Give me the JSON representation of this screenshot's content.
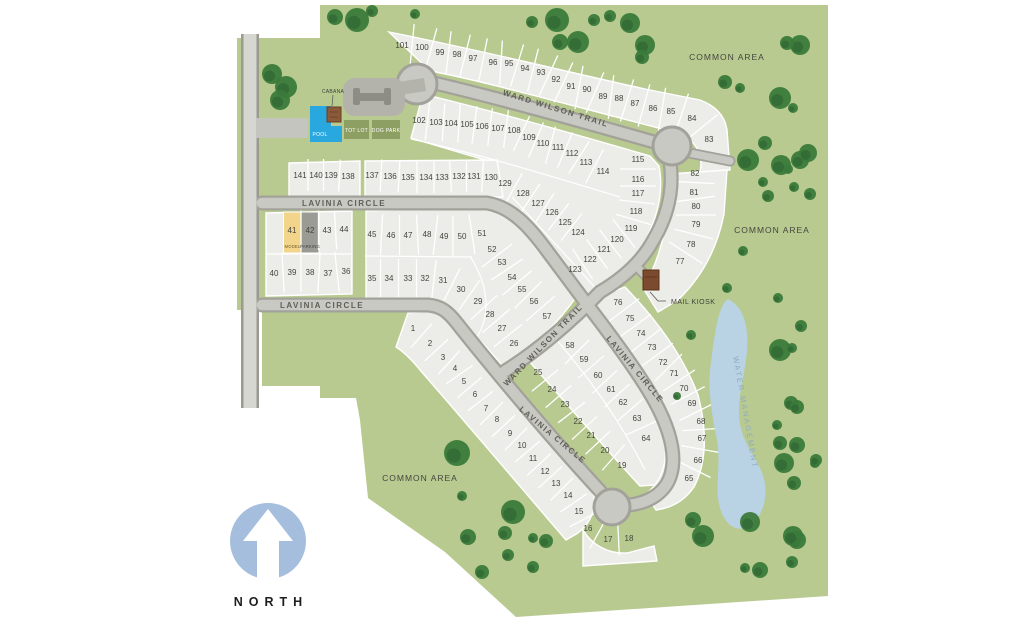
{
  "map": {
    "north_label": "NORTH",
    "street_labels": [
      {
        "text": "WARD WILSON TRAIL",
        "x": 555,
        "y": 111,
        "rotate": 17
      },
      {
        "text": "WARD WILSON TRAIL",
        "x": 545,
        "y": 347,
        "rotate": -46
      },
      {
        "text": "LAVINIA CIRCLE",
        "x": 344,
        "y": 206,
        "rotate": 0
      },
      {
        "text": "LAVINIA CIRCLE",
        "x": 322,
        "y": 308,
        "rotate": 0
      },
      {
        "text": "LAVINIA CIRCLE",
        "x": 633,
        "y": 371,
        "rotate": 50
      },
      {
        "text": "LAVINIA CIRCLE",
        "x": 551,
        "y": 437,
        "rotate": 40
      }
    ],
    "area_labels": [
      {
        "text": "COMMON AREA",
        "x": 727,
        "y": 60
      },
      {
        "text": "COMMON AREA",
        "x": 772,
        "y": 233
      },
      {
        "text": "COMMON AREA",
        "x": 420,
        "y": 481
      }
    ],
    "water_label": {
      "text": "WATER MANAGEMENT",
      "x": 743,
      "y": 413,
      "rotate": 80
    },
    "amenities": {
      "cabana": "CABANA",
      "pool": "POOL",
      "tot_lot": "TOT LOT",
      "dog_park": "DOG PARK",
      "mail_kiosk": "MAIL KIOSK"
    },
    "special_lots": {
      "model": "MODEL",
      "parking": "PARKING"
    },
    "lots": [
      [
        1,
        413,
        328
      ],
      [
        2,
        430,
        343
      ],
      [
        3,
        443,
        357
      ],
      [
        4,
        455,
        368
      ],
      [
        5,
        464,
        381
      ],
      [
        6,
        475,
        394
      ],
      [
        7,
        486,
        408
      ],
      [
        8,
        497,
        419
      ],
      [
        9,
        510,
        433
      ],
      [
        10,
        522,
        445
      ],
      [
        11,
        533,
        458
      ],
      [
        12,
        545,
        471
      ],
      [
        13,
        556,
        483
      ],
      [
        14,
        568,
        495
      ],
      [
        15,
        579,
        511
      ],
      [
        16,
        588,
        528
      ],
      [
        17,
        608,
        539
      ],
      [
        18,
        629,
        538
      ],
      [
        19,
        622,
        465
      ],
      [
        20,
        605,
        450
      ],
      [
        21,
        591,
        435
      ],
      [
        22,
        578,
        421
      ],
      [
        23,
        565,
        404
      ],
      [
        24,
        552,
        389
      ],
      [
        25,
        538,
        372
      ],
      [
        26,
        514,
        343
      ],
      [
        27,
        502,
        328
      ],
      [
        28,
        490,
        314
      ],
      [
        29,
        478,
        301
      ],
      [
        30,
        461,
        289
      ],
      [
        31,
        443,
        280
      ],
      [
        32,
        425,
        278
      ],
      [
        33,
        408,
        278
      ],
      [
        34,
        389,
        278
      ],
      [
        35,
        372,
        278
      ],
      [
        36,
        346,
        271
      ],
      [
        37,
        328,
        273
      ],
      [
        38,
        310,
        272
      ],
      [
        39,
        292,
        272
      ],
      [
        40,
        274,
        273
      ],
      [
        41,
        292,
        230
      ],
      [
        42,
        310,
        230
      ],
      [
        43,
        327,
        230
      ],
      [
        44,
        344,
        229
      ],
      [
        45,
        372,
        234
      ],
      [
        46,
        391,
        235
      ],
      [
        47,
        408,
        235
      ],
      [
        48,
        427,
        234
      ],
      [
        49,
        444,
        236
      ],
      [
        50,
        462,
        236
      ],
      [
        51,
        482,
        233
      ],
      [
        52,
        492,
        249
      ],
      [
        53,
        502,
        262
      ],
      [
        54,
        512,
        277
      ],
      [
        55,
        522,
        289
      ],
      [
        56,
        534,
        301
      ],
      [
        57,
        547,
        316
      ],
      [
        58,
        570,
        345
      ],
      [
        59,
        584,
        359
      ],
      [
        60,
        598,
        375
      ],
      [
        61,
        611,
        389
      ],
      [
        62,
        623,
        402
      ],
      [
        63,
        637,
        418
      ],
      [
        64,
        646,
        438
      ],
      [
        65,
        689,
        478
      ],
      [
        66,
        698,
        460
      ],
      [
        67,
        702,
        438
      ],
      [
        68,
        701,
        421
      ],
      [
        69,
        692,
        403
      ],
      [
        70,
        684,
        388
      ],
      [
        71,
        674,
        373
      ],
      [
        72,
        663,
        362
      ],
      [
        73,
        652,
        347
      ],
      [
        74,
        641,
        333
      ],
      [
        75,
        630,
        318
      ],
      [
        76,
        618,
        302
      ],
      [
        77,
        680,
        261
      ],
      [
        78,
        691,
        244
      ],
      [
        79,
        696,
        224
      ],
      [
        80,
        696,
        206
      ],
      [
        81,
        694,
        192
      ],
      [
        82,
        695,
        173
      ],
      [
        83,
        709,
        139
      ],
      [
        84,
        692,
        118
      ],
      [
        85,
        671,
        111
      ],
      [
        86,
        653,
        108
      ],
      [
        87,
        635,
        103
      ],
      [
        88,
        619,
        98
      ],
      [
        89,
        603,
        96
      ],
      [
        90,
        587,
        89
      ],
      [
        91,
        571,
        86
      ],
      [
        92,
        556,
        79
      ],
      [
        93,
        541,
        72
      ],
      [
        94,
        525,
        68
      ],
      [
        95,
        509,
        63
      ],
      [
        96,
        493,
        62
      ],
      [
        97,
        473,
        58
      ],
      [
        98,
        457,
        54
      ],
      [
        99,
        440,
        52
      ],
      [
        100,
        422,
        47
      ],
      [
        101,
        402,
        45
      ],
      [
        102,
        419,
        120
      ],
      [
        103,
        436,
        122
      ],
      [
        104,
        451,
        123
      ],
      [
        105,
        467,
        124
      ],
      [
        106,
        482,
        126
      ],
      [
        107,
        498,
        128
      ],
      [
        108,
        514,
        130
      ],
      [
        109,
        529,
        137
      ],
      [
        110,
        543,
        143
      ],
      [
        111,
        558,
        147
      ],
      [
        112,
        572,
        153
      ],
      [
        113,
        586,
        162
      ],
      [
        114,
        603,
        171
      ],
      [
        115,
        638,
        159
      ],
      [
        116,
        638,
        179
      ],
      [
        117,
        638,
        193
      ],
      [
        118,
        636,
        211
      ],
      [
        119,
        631,
        228
      ],
      [
        120,
        617,
        239
      ],
      [
        121,
        604,
        249
      ],
      [
        122,
        590,
        259
      ],
      [
        123,
        575,
        269
      ],
      [
        124,
        578,
        232
      ],
      [
        125,
        565,
        222
      ],
      [
        126,
        552,
        212
      ],
      [
        127,
        538,
        203
      ],
      [
        128,
        523,
        193
      ],
      [
        129,
        505,
        183
      ],
      [
        130,
        491,
        177
      ],
      [
        131,
        474,
        176
      ],
      [
        132,
        459,
        176
      ],
      [
        133,
        442,
        177
      ],
      [
        134,
        426,
        177
      ],
      [
        135,
        408,
        177
      ],
      [
        136,
        390,
        176
      ],
      [
        137,
        372,
        175
      ],
      [
        138,
        348,
        176
      ],
      [
        139,
        331,
        175
      ],
      [
        140,
        316,
        175
      ],
      [
        141,
        300,
        175
      ]
    ],
    "rows": [
      {
        "len": 44,
        "lots": [
          101,
          100,
          99,
          98,
          97,
          96,
          95,
          94,
          93,
          92,
          91,
          90,
          89,
          88,
          87,
          86,
          85,
          84,
          83
        ]
      },
      {
        "len": 38,
        "lots": [
          102,
          103,
          104,
          105,
          106,
          107,
          108,
          109,
          110,
          111,
          112,
          113,
          114
        ]
      },
      {
        "len": 36,
        "lots": [
          115,
          116,
          117,
          118,
          119,
          120,
          121,
          122,
          123
        ]
      },
      {
        "len": 34,
        "lots": [
          129,
          128,
          127,
          126,
          125,
          124
        ]
      },
      {
        "len": 32,
        "lots": [
          137,
          136,
          135,
          134,
          133,
          132,
          131,
          130
        ]
      },
      {
        "len": 32,
        "lots": [
          141,
          140,
          139,
          138
        ]
      },
      {
        "len": 40,
        "lots": [
          41,
          42,
          43,
          44
        ]
      },
      {
        "len": 40,
        "lots": [
          40,
          39,
          38,
          37,
          36
        ]
      },
      {
        "len": 40,
        "lots": [
          45,
          46,
          47,
          48,
          49,
          50,
          51
        ]
      },
      {
        "len": 38,
        "lots": [
          35,
          34,
          33,
          32,
          31
        ]
      },
      {
        "len": 38,
        "lots": [
          52,
          53,
          54,
          55,
          56,
          57
        ]
      },
      {
        "len": 36,
        "lots": [
          31,
          30,
          29,
          28,
          27,
          26
        ]
      },
      {
        "len": 32,
        "lots": [
          1,
          2,
          3,
          4,
          5,
          6,
          7,
          8,
          9,
          10,
          11,
          12,
          13,
          14,
          15,
          16
        ]
      },
      {
        "len": 34,
        "lots": [
          16,
          17,
          18
        ]
      },
      {
        "len": 34,
        "lots": [
          25,
          24,
          23,
          22,
          21,
          20,
          19
        ]
      },
      {
        "len": 34,
        "lots": [
          58,
          59,
          60,
          61,
          62,
          63,
          64
        ]
      },
      {
        "len": 38,
        "lots": [
          76,
          75,
          74,
          73,
          72,
          71,
          70,
          69,
          68,
          67,
          66,
          65
        ]
      },
      {
        "len": 40,
        "lots": [
          82,
          81,
          80,
          79,
          78,
          77
        ]
      }
    ],
    "trees": [
      [
        335,
        17,
        8
      ],
      [
        357,
        20,
        12
      ],
      [
        372,
        11,
        6
      ],
      [
        415,
        14,
        5
      ],
      [
        532,
        22,
        6
      ],
      [
        557,
        20,
        12
      ],
      [
        560,
        42,
        8
      ],
      [
        578,
        42,
        11
      ],
      [
        594,
        20,
        6
      ],
      [
        610,
        16,
        6
      ],
      [
        630,
        23,
        10
      ],
      [
        645,
        45,
        10
      ],
      [
        642,
        57,
        7
      ],
      [
        800,
        45,
        10
      ],
      [
        787,
        43,
        7
      ],
      [
        780,
        98,
        11
      ],
      [
        725,
        82,
        7
      ],
      [
        740,
        88,
        5
      ],
      [
        793,
        108,
        5
      ],
      [
        748,
        160,
        11
      ],
      [
        800,
        160,
        9
      ],
      [
        765,
        143,
        7
      ],
      [
        808,
        153,
        9
      ],
      [
        788,
        169,
        5
      ],
      [
        768,
        196,
        6
      ],
      [
        781,
        165,
        10
      ],
      [
        794,
        187,
        5
      ],
      [
        763,
        182,
        5
      ],
      [
        810,
        194,
        6
      ],
      [
        272,
        74,
        10
      ],
      [
        286,
        87,
        11
      ],
      [
        280,
        100,
        10
      ],
      [
        743,
        251,
        5
      ],
      [
        727,
        288,
        5
      ],
      [
        778,
        298,
        5
      ],
      [
        691,
        335,
        5
      ],
      [
        780,
        350,
        11
      ],
      [
        791,
        403,
        7
      ],
      [
        777,
        425,
        5
      ],
      [
        780,
        443,
        7
      ],
      [
        784,
        463,
        10
      ],
      [
        815,
        463,
        5
      ],
      [
        801,
        326,
        6
      ],
      [
        792,
        348,
        5
      ],
      [
        797,
        407,
        7
      ],
      [
        797,
        445,
        8
      ],
      [
        816,
        460,
        6
      ],
      [
        794,
        483,
        7
      ],
      [
        797,
        540,
        9
      ],
      [
        792,
        562,
        6
      ],
      [
        677,
        396,
        4
      ],
      [
        693,
        520,
        8
      ],
      [
        703,
        536,
        11
      ],
      [
        750,
        522,
        10
      ],
      [
        793,
        536,
        10
      ],
      [
        745,
        568,
        5
      ],
      [
        760,
        570,
        8
      ],
      [
        457,
        453,
        13
      ],
      [
        462,
        496,
        5
      ],
      [
        513,
        512,
        12
      ],
      [
        468,
        537,
        8
      ],
      [
        505,
        533,
        7
      ],
      [
        533,
        538,
        5
      ],
      [
        546,
        541,
        7
      ],
      [
        508,
        555,
        6
      ],
      [
        482,
        572,
        7
      ],
      [
        533,
        567,
        6
      ]
    ],
    "colors": {
      "grass": "#b8ca90",
      "lot": "#ecece8",
      "road": "#c9c9c3",
      "road_casing": "#a2a29a",
      "tree": "#3a7a3b",
      "water": "#b9d3e4",
      "pool": "#29a8e0",
      "rec": "#8e9f63",
      "north_circle": "#a6bedd",
      "kiosk": "#7c4a2e",
      "model_lot": "#f2d58a",
      "parking_lot": "#9b9b96"
    }
  }
}
